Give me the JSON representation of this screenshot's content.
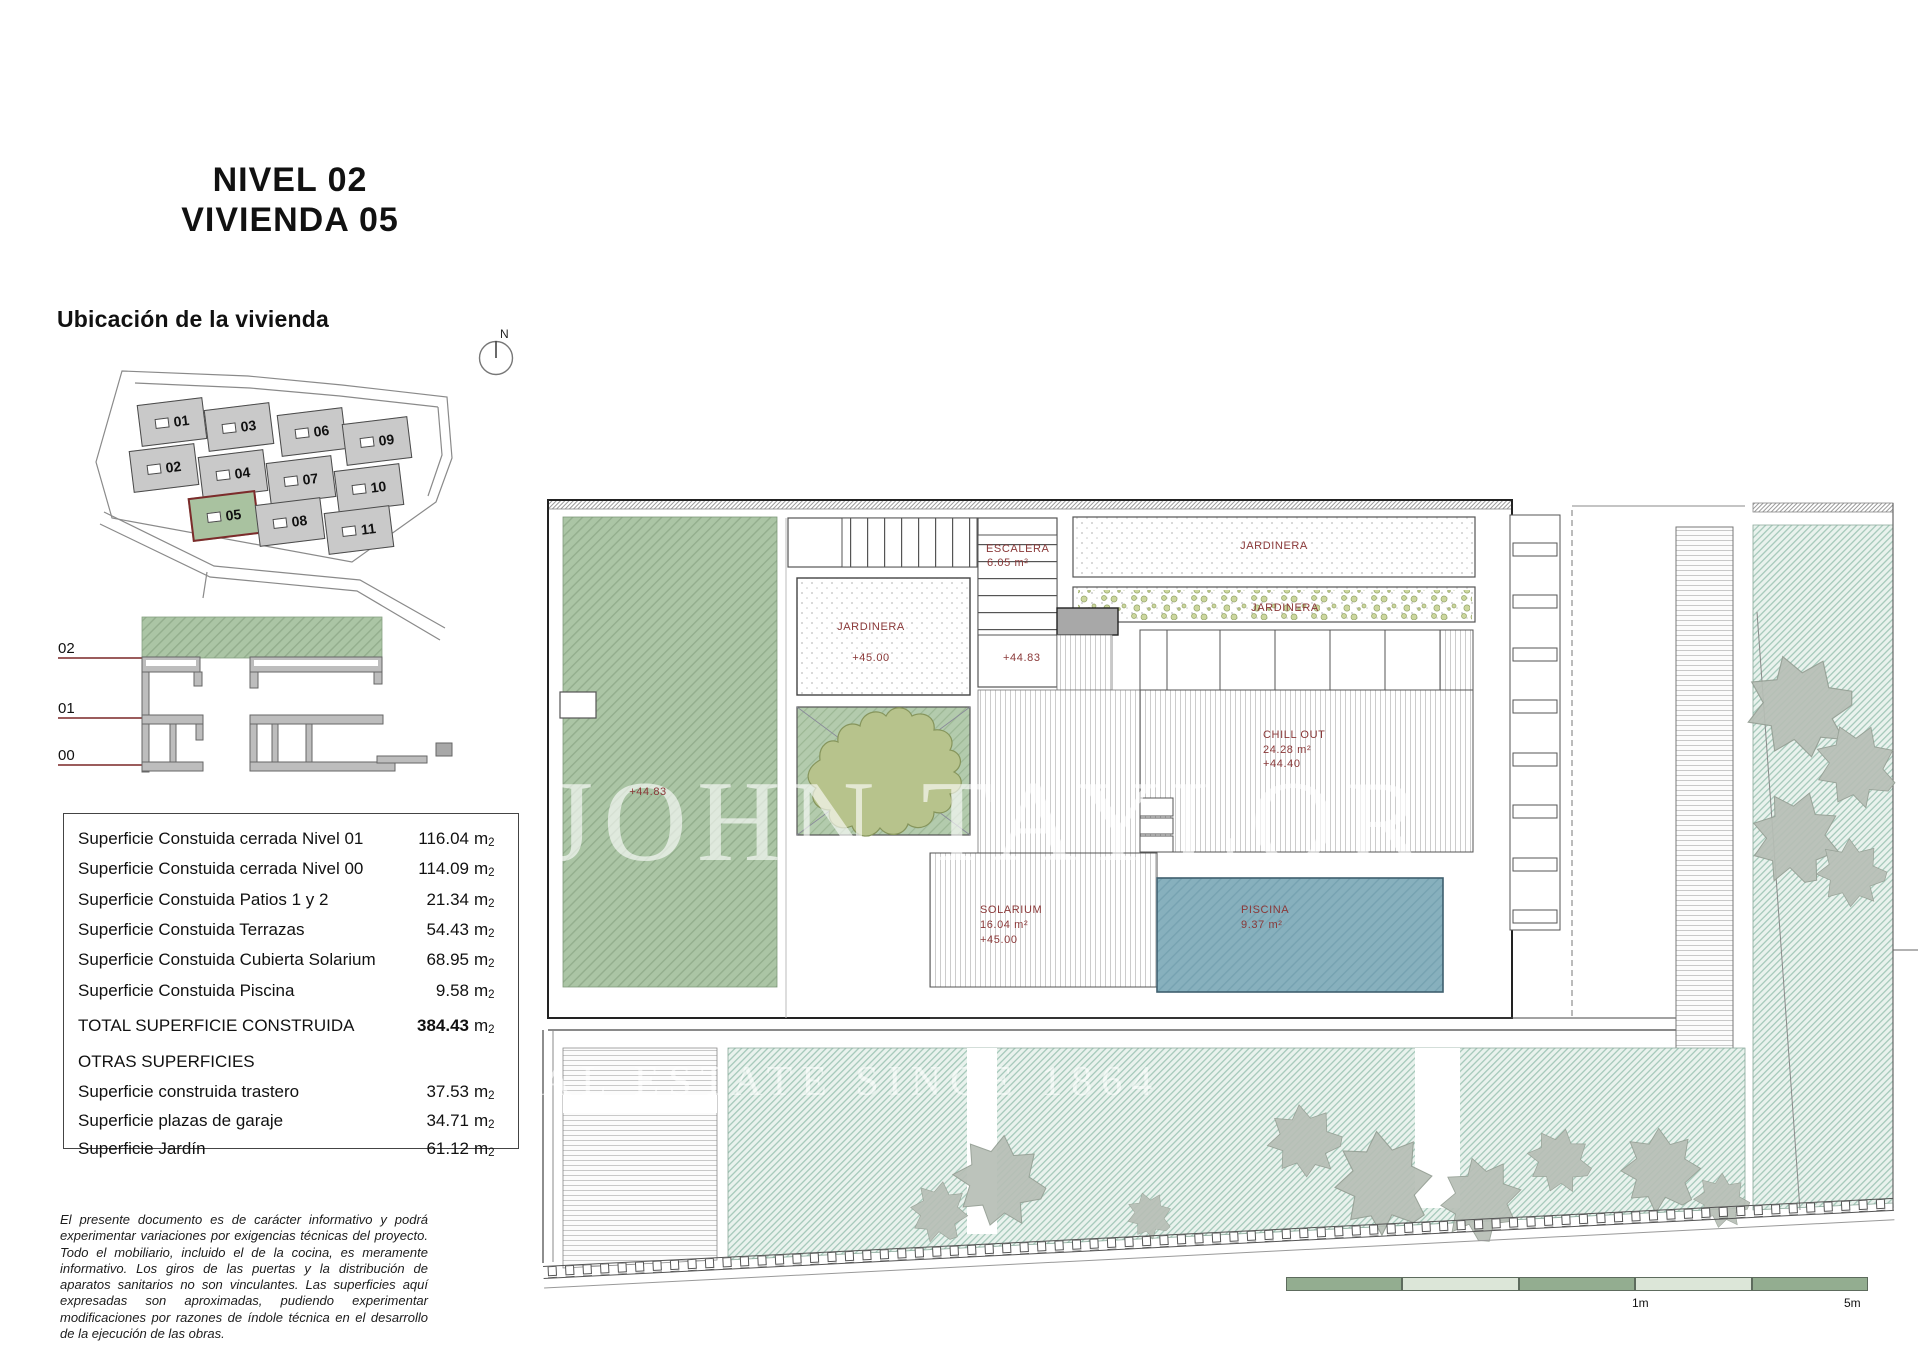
{
  "title": {
    "line1": "NIVEL 02",
    "line2": "VIVIENDA 05"
  },
  "location": {
    "heading": "Ubicación de la vivienda",
    "north_label": "N",
    "units": [
      "01",
      "03",
      "06",
      "09",
      "02",
      "04",
      "07",
      "10",
      "05",
      "08",
      "11"
    ],
    "highlighted_unit": "05"
  },
  "section": {
    "levels": [
      "02",
      "01",
      "00"
    ]
  },
  "areas_table": {
    "rows": [
      {
        "label": "Superficie Constuida cerrada Nivel 01",
        "value": "116.04"
      },
      {
        "label": "Superficie Constuida cerrada Nivel 00",
        "value": "114.09"
      },
      {
        "label": "Superficie Constuida Patios 1 y 2",
        "value": "21.34"
      },
      {
        "label": "Superficie Constuida Terrazas",
        "value": "54.43"
      },
      {
        "label": "Superficie Constuida Cubierta Solarium",
        "value": "68.95"
      },
      {
        "label": "Superficie Constuida Piscina",
        "value": "9.58"
      }
    ],
    "total": {
      "label": "TOTAL SUPERFICIE CONSTRUIDA",
      "value": "384.43"
    },
    "otras_heading": "OTRAS SUPERFICIES",
    "otras_rows": [
      {
        "label": "Superficie construida trastero",
        "value": "37.53"
      },
      {
        "label": "Superficie plazas de garaje",
        "value": "34.71"
      },
      {
        "label": "Superficie Jardín",
        "value": "61.12"
      }
    ],
    "unit_main": "m",
    "unit_sub": "2"
  },
  "disclaimer": "El presente documento es de carácter informativo y podrá experimentar variaciones por exigencias técnicas del proyecto. Todo el mobiliario, incluido el de la cocina, es meramente informativo. Los giros de las puertas y la distribución de aparatos sanitarios no son vinculantes. Las superficies aquí expresadas son aproximadas, pudiendo experimentar modificaciones por razones de índole técnica en el desarrollo de la ejecución de las obras.",
  "plan": {
    "escalera": [
      "ESCALERA",
      "6.05 m²"
    ],
    "jardinera_top": "JARDINERA",
    "jardinera_mid": "JARDINERA",
    "jardinera_room": [
      "JARDINERA",
      "+45.00"
    ],
    "terrace_level": "+44.83",
    "mid_level": "+44.83",
    "chill_out": [
      "CHILL OUT",
      "24.28 m²",
      "+44.40"
    ],
    "solarium": [
      "SOLARIUM",
      "16.04 m²",
      "+45.00"
    ],
    "piscina": [
      "PISCINA",
      "9.37 m²"
    ]
  },
  "watermark": {
    "line1": "JOHN TAYLOR",
    "line2": "REAL ESTATE SINCE 1864"
  },
  "scale_bar": {
    "label_1m": "1m",
    "label_5m": "5m"
  },
  "colors": {
    "label_red": "#8a3838",
    "terrace_green": "#abc5a5",
    "pool_blue": "#87b0bd",
    "garden_hatch": "#a6c9bb",
    "site_block_gray": "#c9c9c9",
    "highlight_border": "#7c2b2b",
    "scale_green": "#93ad90"
  }
}
